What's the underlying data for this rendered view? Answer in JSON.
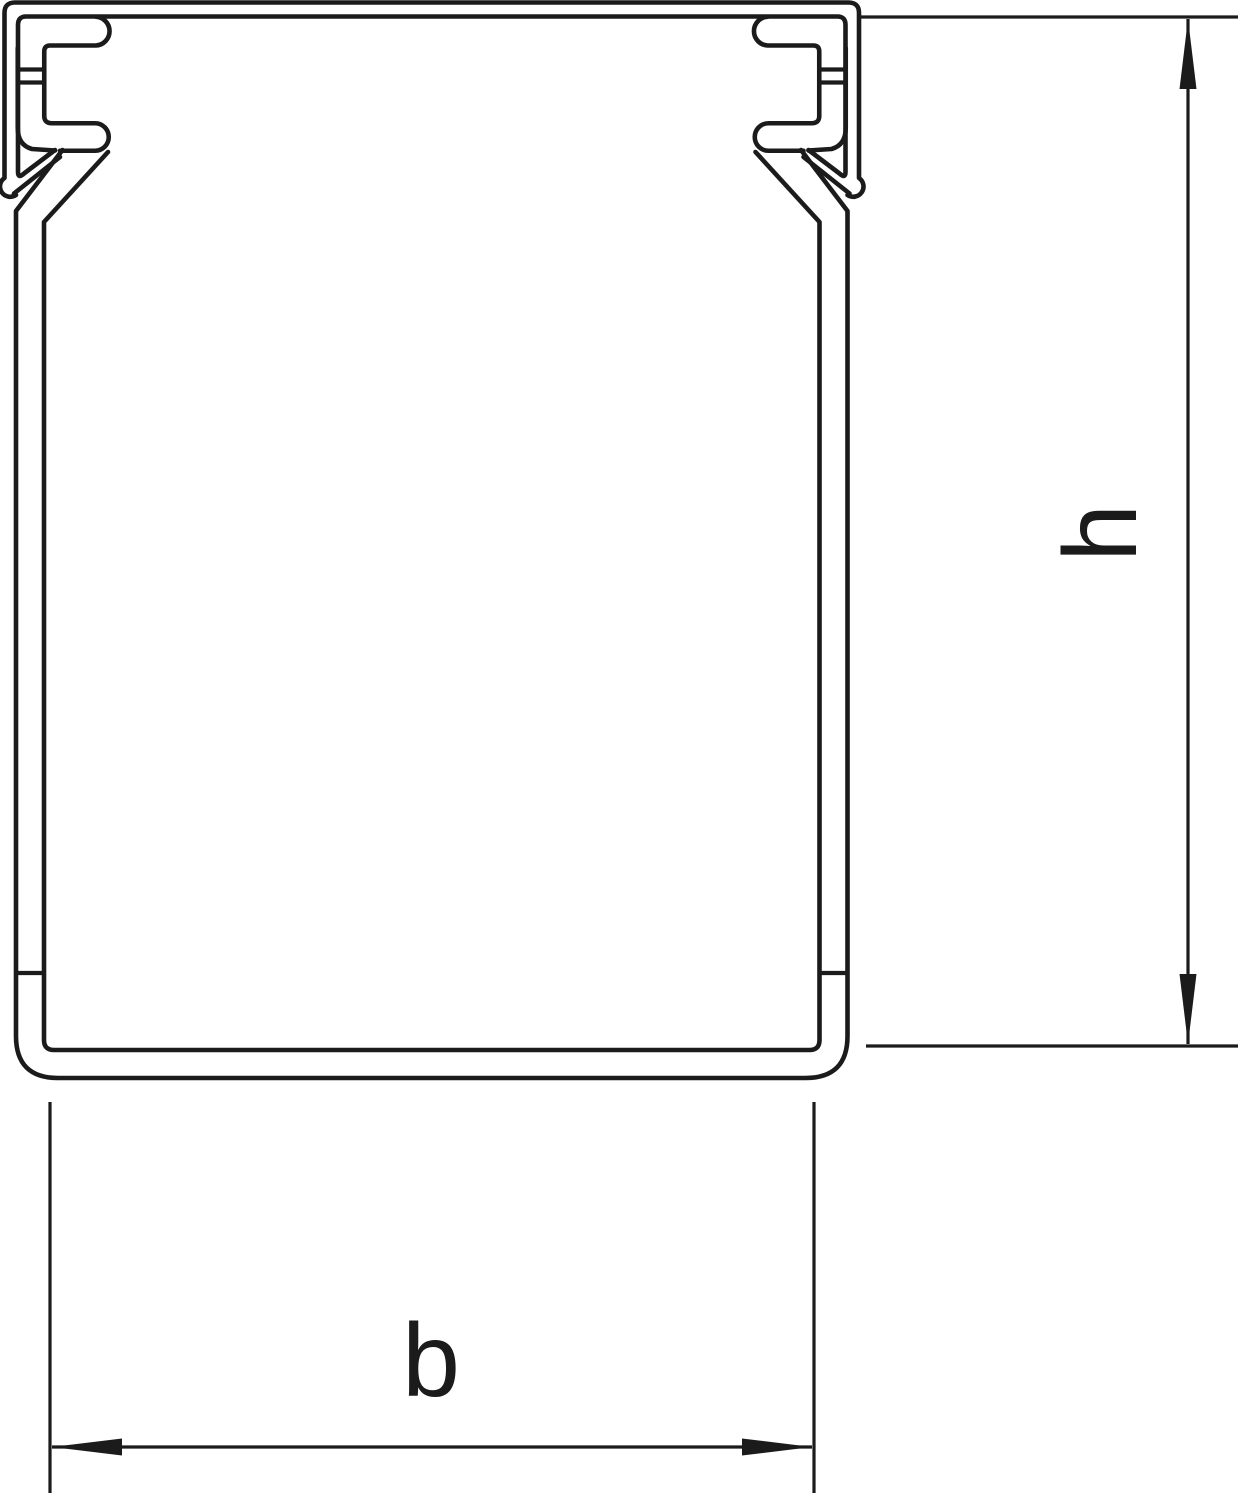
{
  "drawing": {
    "description": "Technical cross-section drawing of a slotted wiring duct (cable trunking) profile",
    "line_color": "#1b1b1b",
    "background_color": "#ffffff",
    "dimensions": {
      "height": {
        "label": "h"
      },
      "width": {
        "label": "b"
      }
    }
  }
}
